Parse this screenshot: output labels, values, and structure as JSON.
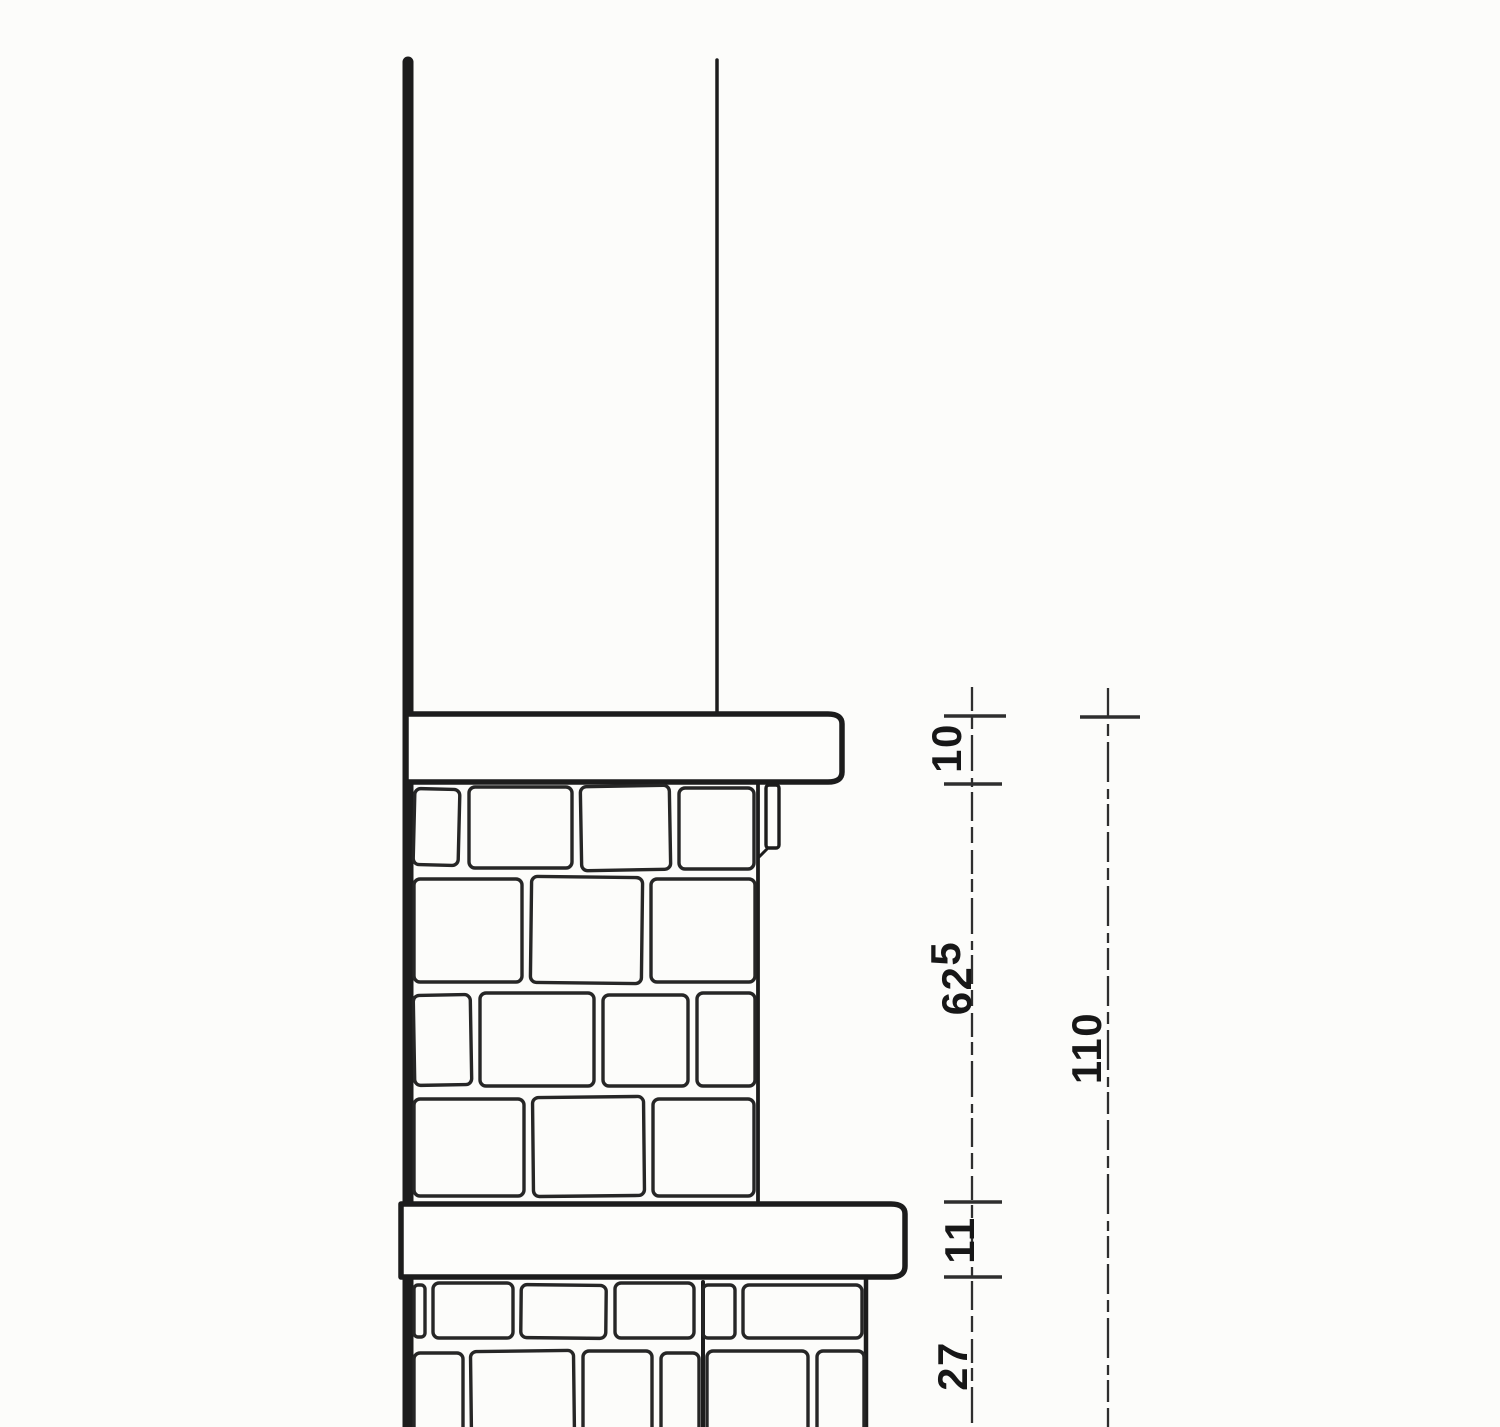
{
  "document": {
    "type": "architectural-section-drawing",
    "description": "Scanned black-ink section detail of a stone masonry parapet wall with two projecting copings, drip groove and vertical dimension chains",
    "background_color": "#fcfcfa",
    "ink_color": "#1c1c1c"
  },
  "dimensions": {
    "upper_coping_thickness": "10",
    "upper_wall_height_main": "62",
    "upper_wall_height_sup": "5",
    "lower_coping_thickness": "11",
    "base_course_height": "27",
    "overall_height": "110"
  }
}
